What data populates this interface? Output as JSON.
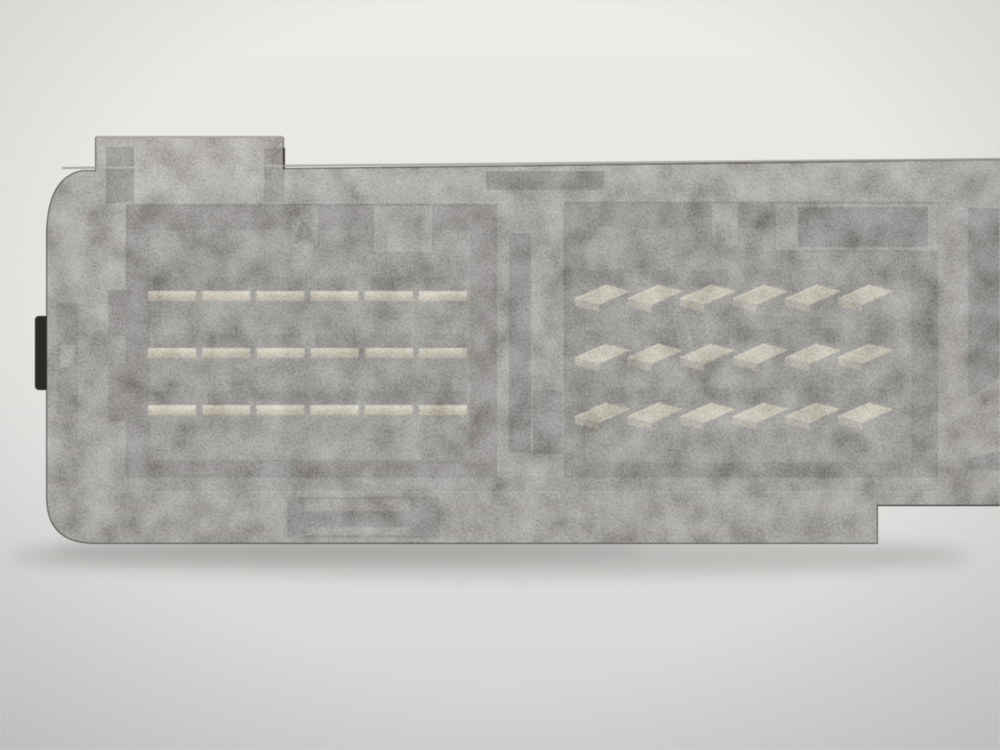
{
  "photo": {
    "description": "Close-up photograph of a weathered black plastic automotive control-module connector block on a light grey background, showing two recessed pin sockets",
    "connector_count": "2"
  },
  "connectors": [
    {
      "label": "A",
      "pin_rows": [
        [
          "1",
          "4",
          "7",
          "10",
          "13",
          "16"
        ],
        [
          "2",
          "5",
          "8",
          "11",
          "14",
          "17"
        ],
        [
          "3",
          "6",
          "9",
          "12",
          "15",
          "18"
        ]
      ]
    },
    {
      "label": "B",
      "pin_rows": [
        [
          "1",
          "4",
          "7",
          "10",
          "13",
          "16"
        ],
        [
          "2",
          "5",
          "8",
          "11",
          "14",
          "17"
        ],
        [
          "3",
          "6",
          "9",
          "12",
          "15",
          "18"
        ]
      ]
    }
  ],
  "colors": {
    "background_top": "#eeece7",
    "background_bottom": "#d9d8d6",
    "housing_face": "#56544f",
    "cavity": "#171613",
    "pin_brass": "#d2c193",
    "number_emboss": "#1c1b16"
  }
}
